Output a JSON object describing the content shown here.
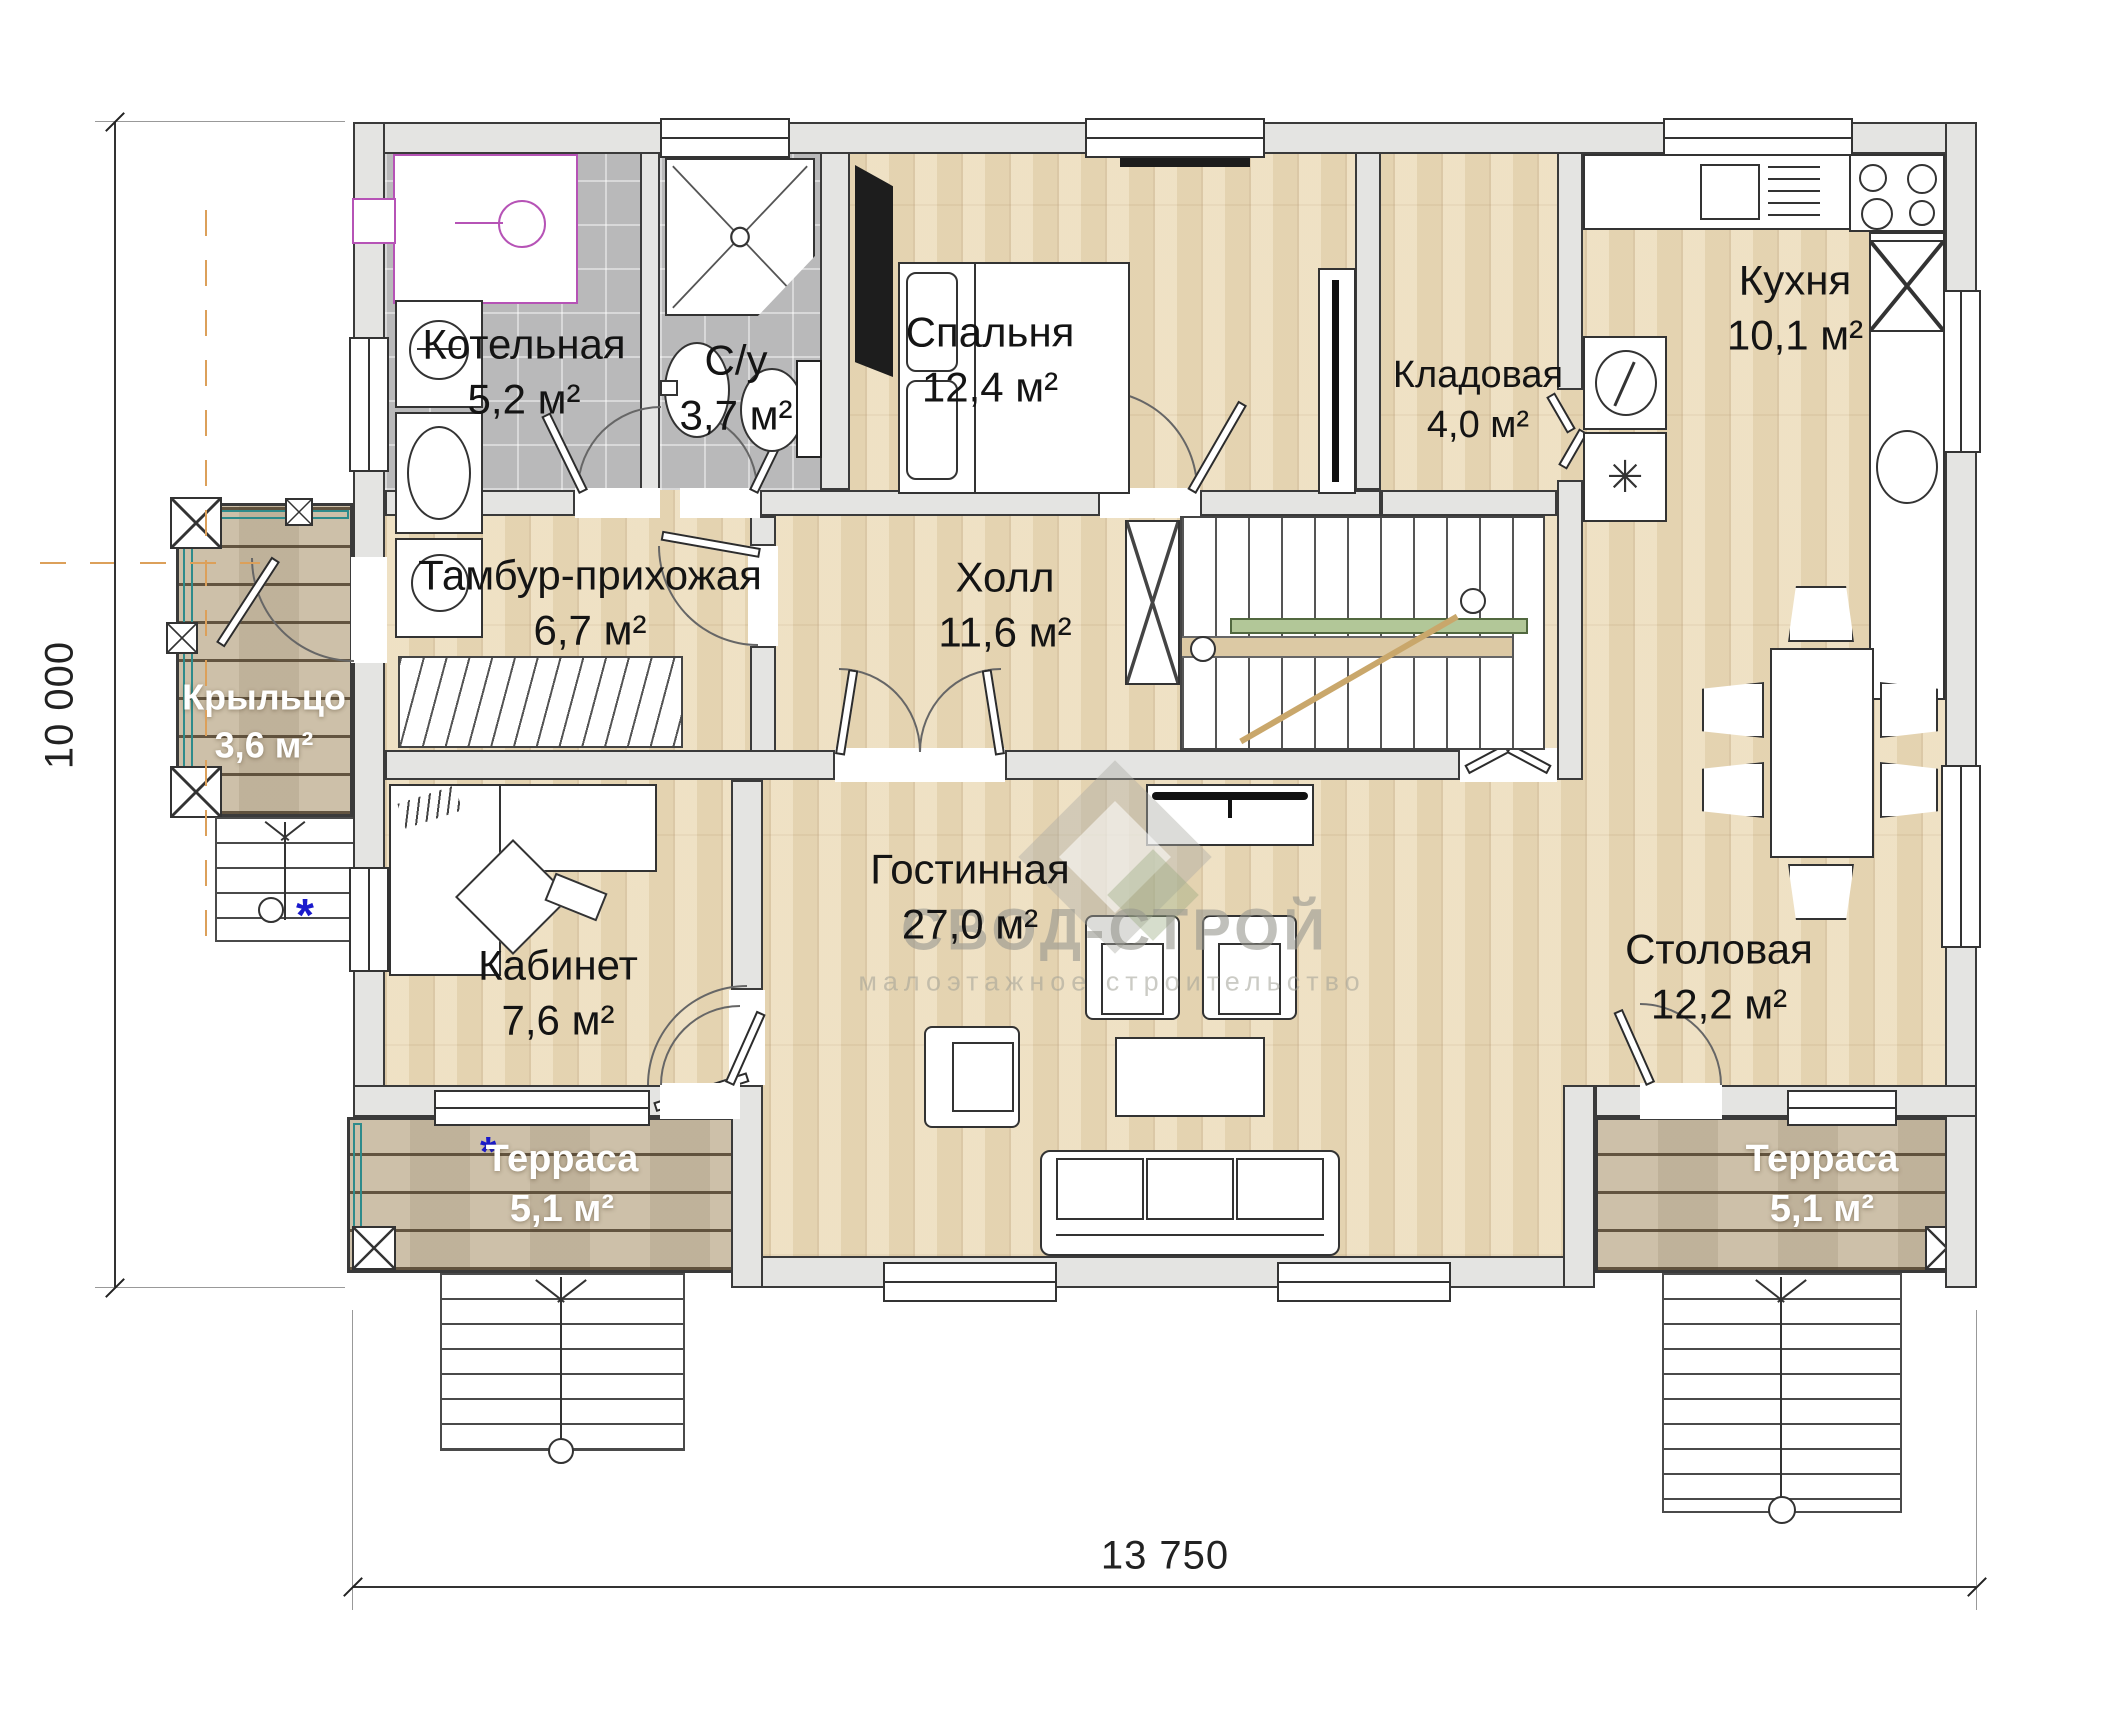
{
  "watermark": {
    "title": "СВОД-СТРОЙ",
    "subtitle": "малоэтажное строительство"
  },
  "dimensions": {
    "width": "13 750",
    "height": "10 000"
  },
  "symbols": {
    "asterisk": "*",
    "snowflake": "✳"
  },
  "rooms": {
    "boiler_room": {
      "name": "Котельная",
      "area": "5,2 м²"
    },
    "bathroom": {
      "name": "С/у",
      "area": "3,7 м²"
    },
    "bedroom": {
      "name": "Спальня",
      "area": "12,4 м²"
    },
    "pantry": {
      "name": "Кладовая",
      "area": "4,0 м²"
    },
    "kitchen": {
      "name": "Кухня",
      "area": "10,1 м²"
    },
    "vestibule": {
      "name": "Тамбур-прихожая",
      "area": "6,7 м²"
    },
    "hall": {
      "name": "Холл",
      "area": "11,6 м²"
    },
    "porch": {
      "name": "Крыльцо",
      "area": "3,6 м²"
    },
    "office": {
      "name": "Кабинет",
      "area": "7,6 м²"
    },
    "living_room": {
      "name": "Гостинная",
      "area": "27,0 м²"
    },
    "dining_room": {
      "name": "Столовая",
      "area": "12,2 м²"
    },
    "terrace_left": {
      "name": "Терраса",
      "area": "5,1 м²"
    },
    "terrace_right": {
      "name": "Терраса",
      "area": "5,1 м²"
    }
  }
}
